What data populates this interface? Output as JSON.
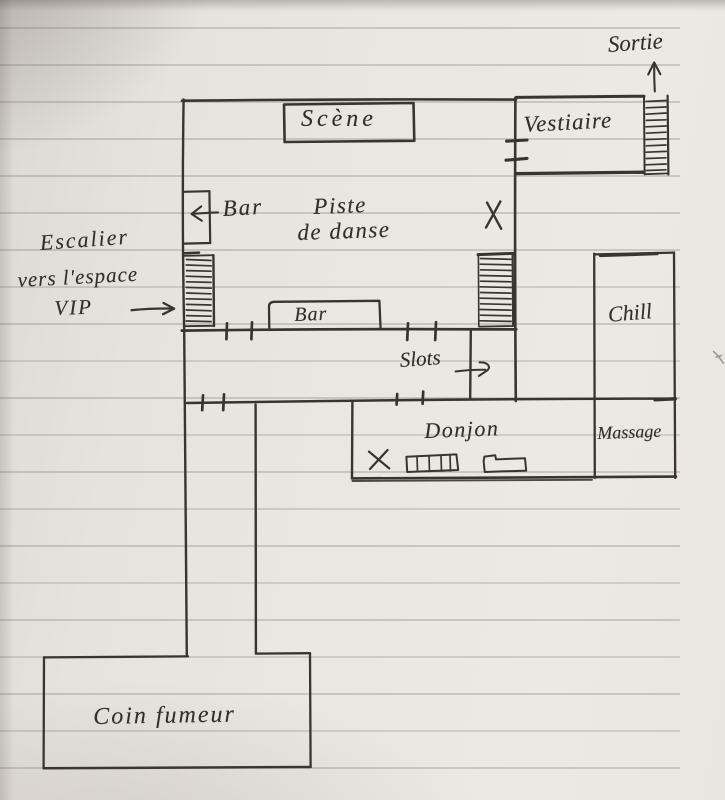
{
  "plan": {
    "labels": {
      "sortie": "Sortie",
      "scene": "Scène",
      "vestiaire": "Vestiaire",
      "bar_top": "Bar",
      "dance_floor_line1": "Piste",
      "dance_floor_line2": "de danse",
      "bar_bottom": "Bar",
      "vip_note_line1": "Escalier",
      "vip_note_line2": "vers l'espace",
      "vip_note_line3": "VIP",
      "slots": "Slots",
      "chill": "Chill",
      "donjon": "Donjon",
      "massage": "Massage",
      "smoking_corner": "Coin fumeur"
    },
    "colors": {
      "ink": "#39342f",
      "paper": "#e8e4df",
      "rule_line": "#8d8b86"
    }
  }
}
